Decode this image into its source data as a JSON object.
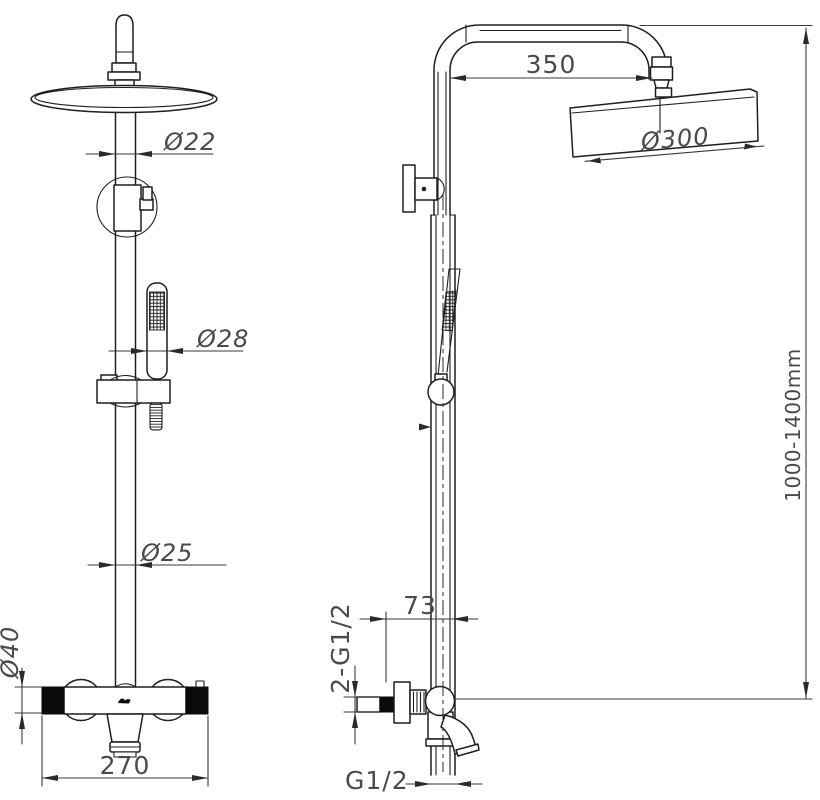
{
  "page": {
    "background": "#ffffff",
    "line_color": "#1f1f1f",
    "dim_text_color": "#4a4a4a"
  },
  "drawing": {
    "kind": "technical line drawing - shower column, front and side elevations",
    "front_view": {
      "dim_top_pipe_diameter": "Ø22",
      "dim_hand_shower_diameter": "Ø28",
      "dim_riser_diameter": "Ø25",
      "dim_valve_body_diameter": "Ø40",
      "dim_valve_width": "270"
    },
    "side_view": {
      "dim_arm_reach": "350",
      "dim_head_diameter": "Ø300",
      "dim_height_range": "1000-1400mm",
      "dim_wall_offset": "73",
      "dim_inlet_connections": "2-G1/2",
      "dim_outlet_connection": "G1/2"
    }
  }
}
